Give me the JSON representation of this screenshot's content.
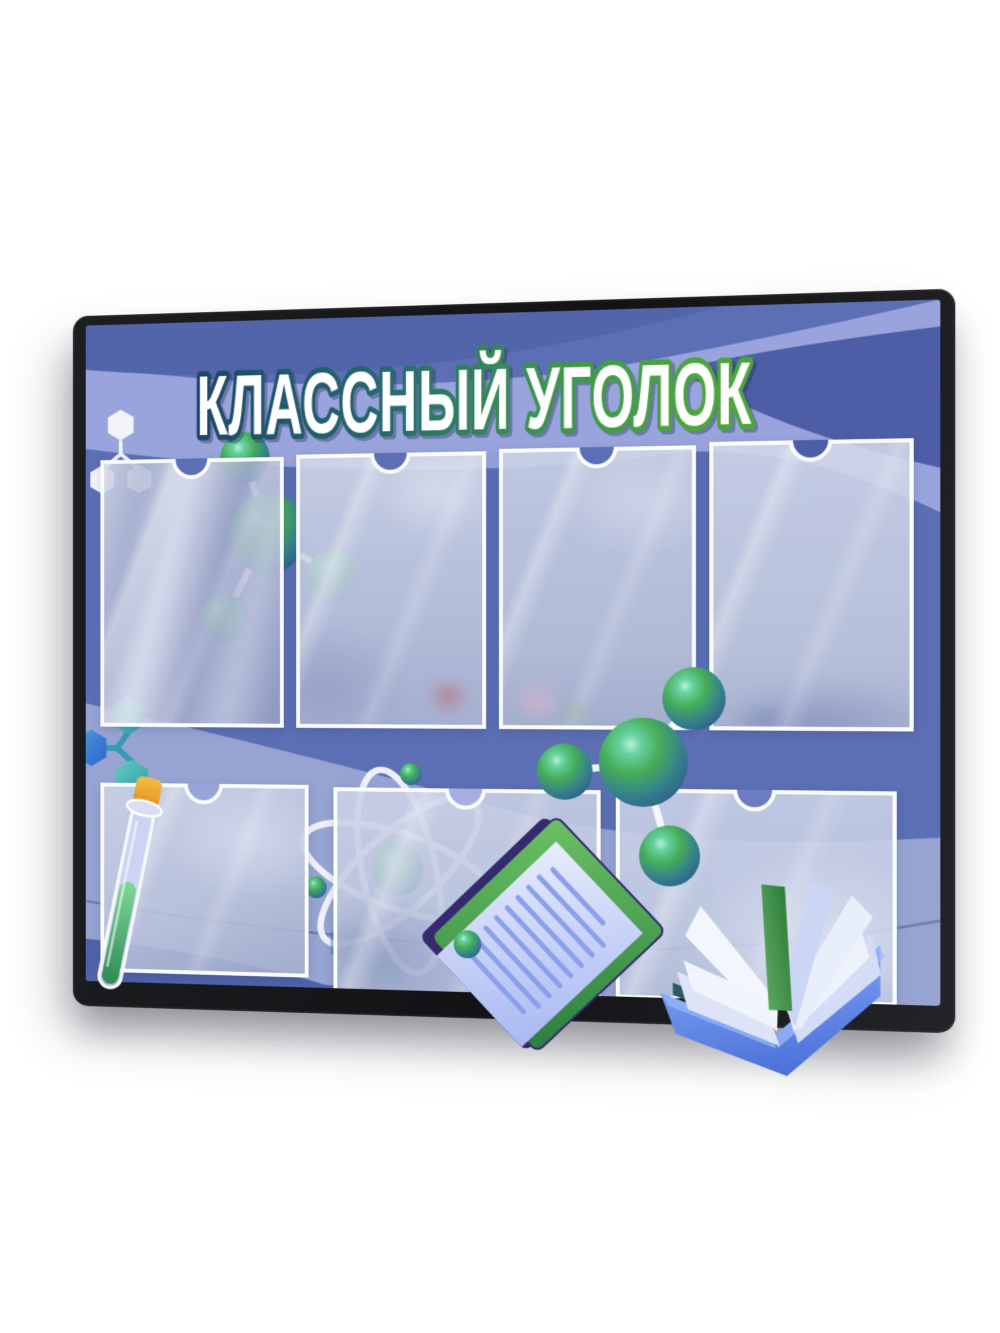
{
  "board": {
    "title": "КЛАССНЫЙ УГОЛОК",
    "pockets": {
      "top_row_count": 4,
      "bottom_row_count": 3,
      "backdrop": "blurred classroom photo",
      "border_color": "#ffffff"
    },
    "decorations": {
      "top_left_icon": "white-structural-formula-icon",
      "top_molecule": "green-3d-molecule",
      "left_icon": "teal-blue-hexagon-molecule-icon",
      "center_icon": "atom-orbitals-icon",
      "right_molecule": "green-3d-molecule",
      "bottom_left_icon": "test-tube-icon",
      "bottom_center_icon": "clipboard-document-icon",
      "bottom_right_icon": "open-book-icon"
    },
    "colors": {
      "frame": "#17181a",
      "board_blue": "#5c6fb4",
      "band_dark_blue": "#5264aa",
      "band_light_blue": "#98a4db",
      "swath_light": "#e9edfa",
      "title_fill": "#ffffff",
      "title_outline_left": "#1d4668",
      "title_outline_right": "#4da53c",
      "molecule_green": "#46ad58",
      "molecule_teal": "#2b6186",
      "cork_orange": "#f0a42a",
      "liquid_green": "#2d8a55",
      "book_cover_blue": "#5f8cec",
      "spine_green": "#3f8f4a",
      "clipboard_green": "#4ea44e",
      "clipboard_edge_navy": "#352a6e"
    }
  }
}
